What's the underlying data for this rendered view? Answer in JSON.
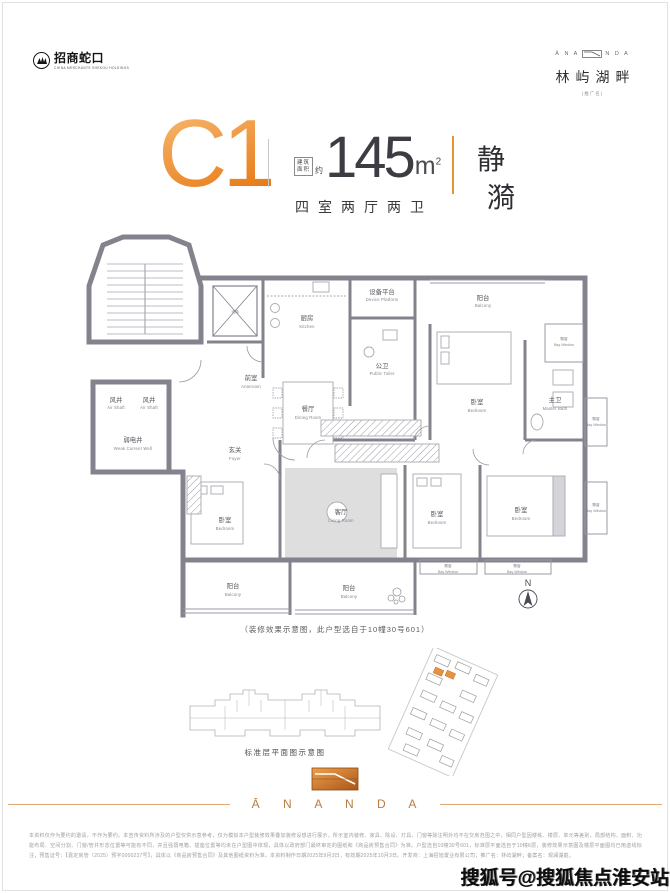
{
  "colors": {
    "accent_orange": "#e8872b",
    "wall_gray": "#83838d",
    "text_dark": "#3a3a40",
    "brand_tan": "#b97c42"
  },
  "header": {
    "developer": {
      "name_cn": "招商蛇口",
      "name_en": "CHINA MERCHANTS SHEKOU HOLDINGS"
    },
    "brand": {
      "wordmark_left": "Ā N A",
      "wordmark_right": "N D A",
      "name": "林屿湖畔",
      "note": "(推广名)"
    }
  },
  "title": {
    "unit": "C1",
    "area_label_line1": "建筑",
    "area_label_line2": "面积",
    "approx": "约",
    "area_value": "145",
    "area_unit": "m",
    "area_sup": "2",
    "layout_desc": "四室两厅两卫",
    "theme_char1": "静",
    "theme_char2": "漪"
  },
  "plan": {
    "north_label": "N",
    "caption": "（装修效果示意图，此户型选自于10幢30号601）",
    "rooms": {
      "lift": {
        "cn": "电梯",
        "en": "Lift"
      },
      "anteroom": {
        "cn": "前室",
        "en": "Anteroom"
      },
      "air_shaft_1": {
        "cn": "风井",
        "en": "Air Shaft"
      },
      "air_shaft_2": {
        "cn": "风井",
        "en": "Air Shaft"
      },
      "weak_current_well": {
        "cn": "弱电井",
        "en": "Weak Current Well"
      },
      "kitchen": {
        "cn": "厨房",
        "en": "Kitchen"
      },
      "device_platform": {
        "cn": "设备平台",
        "en": "Device Platform"
      },
      "public_toilet": {
        "cn": "公卫",
        "en": "Public Toilet"
      },
      "dining_room": {
        "cn": "餐厅",
        "en": "Dining Room"
      },
      "balcony_top": {
        "cn": "阳台",
        "en": "Balcony"
      },
      "bedroom_top_right": {
        "cn": "卧室",
        "en": "Bedroom"
      },
      "bay_window_top_right": {
        "cn": "飘窗",
        "en": "Bay Window"
      },
      "master_bath": {
        "cn": "主卫",
        "en": "Master Bath"
      },
      "bay_window_right": {
        "cn": "飘窗",
        "en": "Bay Window"
      },
      "foyer": {
        "cn": "玄关",
        "en": "Foyer"
      },
      "bedroom_left": {
        "cn": "卧室",
        "en": "Bedroom"
      },
      "living_room": {
        "cn": "客厅",
        "en": "Living Room"
      },
      "balcony_left": {
        "cn": "阳台",
        "en": "Balcony"
      },
      "balcony_center": {
        "cn": "阳台",
        "en": "Balcony"
      },
      "bedroom_mid": {
        "cn": "卧室",
        "en": "Bedroom"
      },
      "bedroom_right": {
        "cn": "卧室",
        "en": "Bedroom"
      },
      "bay_window_b1": {
        "cn": "飘窗",
        "en": "Bay Window"
      },
      "bay_window_b2": {
        "cn": "飘窗",
        "en": "Bay Window"
      },
      "bay_window_r2": {
        "cn": "飘窗",
        "en": "Bay Window"
      }
    }
  },
  "floorplate": {
    "caption": "标准层平面图示意图"
  },
  "footer": {
    "wordmark": "Ā N A N D A"
  },
  "disclaimer": {
    "text": "本资料仅作为要约的邀请，不作为要约。本宣传资料所涉及的户型仅供示意参考，仅为模拟本户型装修效果叠加装修设想进行展示，所示室内装修、家具、陈设、灯具、门窗等除注明外均不在交房范围之中，相同户型因楼栋、楼层、单元等差别，局部结构、面积、功能布局、空间分割、门窗/管井形态位置等可能有不同，并且强弱电箱、插座位置等均未在户型图中体现，具体以政府部门最终审定的图纸和《商品房预售合同》为准。户型选自10幢30号601，标准层平面选自于10幢6层，装修效果示意图及楼层平面图均已用虚线标注，预售证号：【嘉定房管（2025）预字0000237号】，具体以《商品房预售合同》及其他图纸资料为准。本资料制作日期2025年9月3日，有效期2025年10月3日。开发商：上海招旭置业有限公司；推广名：林屿湖畔；备案名：观澜湖庭。"
  },
  "watermark": {
    "text": "搜狐号@搜狐焦点淮安站"
  }
}
